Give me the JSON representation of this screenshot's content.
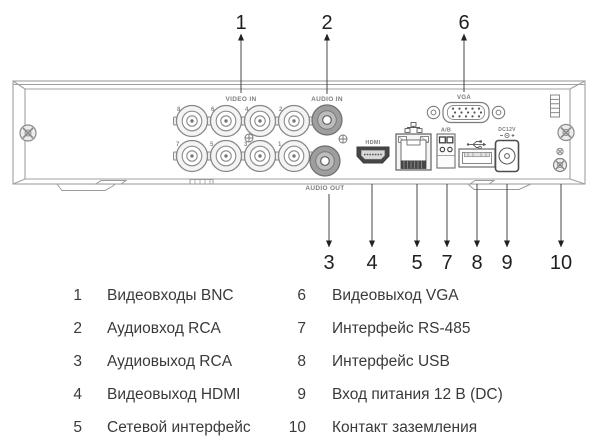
{
  "panel": {
    "labels": {
      "video_in": "VIDEO IN",
      "audio_in": "AUDIO IN",
      "audio_out": "AUDIO OUT",
      "hdmi": "HDMI",
      "vga": "VGA",
      "rs485": "A/B",
      "power": "DC12V"
    },
    "bnc_top": [
      "8",
      "6",
      "4",
      "2"
    ],
    "bnc_bottom": [
      "7",
      "5",
      "3",
      "1"
    ]
  },
  "callouts": {
    "top": [
      "1",
      "2",
      "6"
    ],
    "bottom": [
      "3",
      "4",
      "5",
      "7",
      "8",
      "9",
      "10"
    ]
  },
  "legend": {
    "left": [
      {
        "num": "1",
        "label": "Видеовходы BNC"
      },
      {
        "num": "2",
        "label": "Аудиовход RCA"
      },
      {
        "num": "3",
        "label": "Аудиовыход RCA"
      },
      {
        "num": "4",
        "label": "Видеовыход HDMI"
      },
      {
        "num": "5",
        "label": "Сетевой интерфейс"
      }
    ],
    "right": [
      {
        "num": "6",
        "label": "Видеовыход VGA"
      },
      {
        "num": "7",
        "label": "Интерфейс RS-485"
      },
      {
        "num": "8",
        "label": "Интерфейс USB"
      },
      {
        "num": "9",
        "label": "Вход питания 12 В (DC)"
      },
      {
        "num": "10",
        "label": "Контакт заземления"
      }
    ]
  },
  "icons": {
    "ethernet": "network-nodes-icon",
    "usb": "usb-trident-icon",
    "ground": "ground-screw-icon",
    "power_polarity": "dc-polarity-icon"
  },
  "colors": {
    "chassis_line": "#a0a0a0",
    "connector_line": "#848484",
    "dark_detail": "#454545",
    "silkscreen": "#7d7d7d",
    "callout": "#1f1f1f",
    "legend_text": "#3a3a3a",
    "background": "#ffffff"
  }
}
